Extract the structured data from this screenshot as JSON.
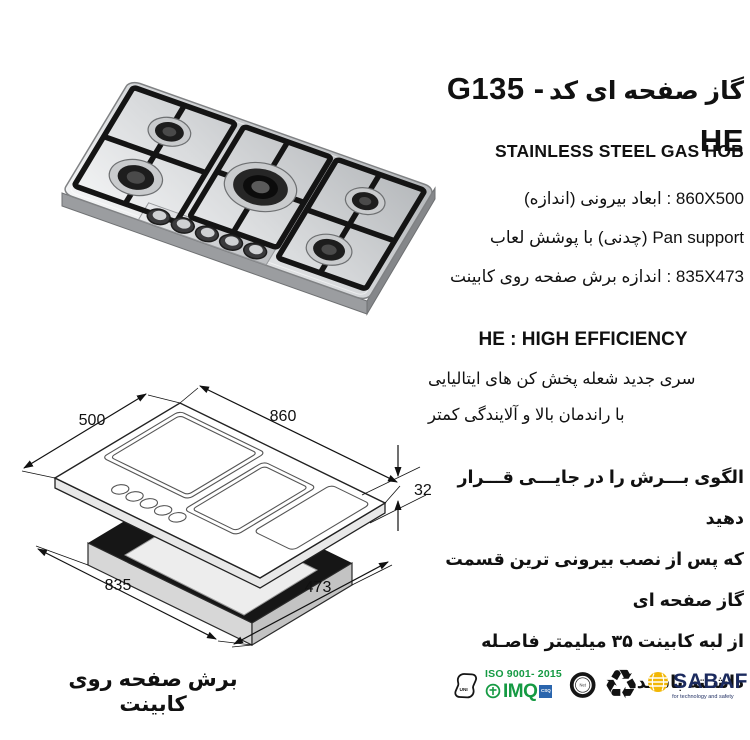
{
  "header": {
    "title_fa": "گاز صفحه ای کد",
    "code": "G135 - HE",
    "subtitle": "STAINLESS STEEL GAS HOB"
  },
  "specs": {
    "line1": "860X500 : ابعاد بیرونی (اندازه)",
    "line2": "Pan support (چدنی)  با پوشش لعاب",
    "line3": "835X473 : اندازه برش صفحه روی کابینت"
  },
  "efficiency": {
    "title": "HE : HIGH EFFICIENCY",
    "line1": "سری جدید شعله پخش کن های ایتالیایی",
    "line2": "با راندمان بالا و آلایندگی کمتر"
  },
  "note": {
    "line1": "الگوی بـــرش را در جایـــی قـــرار دهید",
    "line2": "که پس از نصب بیرونی ترین قسمت گاز صفحه ای",
    "line3": "از لبه کابینت ۳۵ میلیمتر فاصـله داشـته باشـد."
  },
  "caption": "برش صفحه روی کابینت",
  "drawing": {
    "dim_depth": "500",
    "dim_width": "860",
    "dim_height": "32",
    "dim_cut_width": "835",
    "dim_cut_depth": "473"
  },
  "logos": {
    "uni": "UNI",
    "iso": "ISO 9001- 2015",
    "imq": "IMQ",
    "csq": "CSQ",
    "ring_center": "Net",
    "recycle_symbol": "♻",
    "sabaf": "SABAF",
    "sabaf_tagline": "for technology and safety"
  },
  "colors": {
    "green": "#159a43",
    "blue": "#2a65ad",
    "navy": "#1b2a5e",
    "yellow": "#f2b705",
    "black": "#111111"
  }
}
